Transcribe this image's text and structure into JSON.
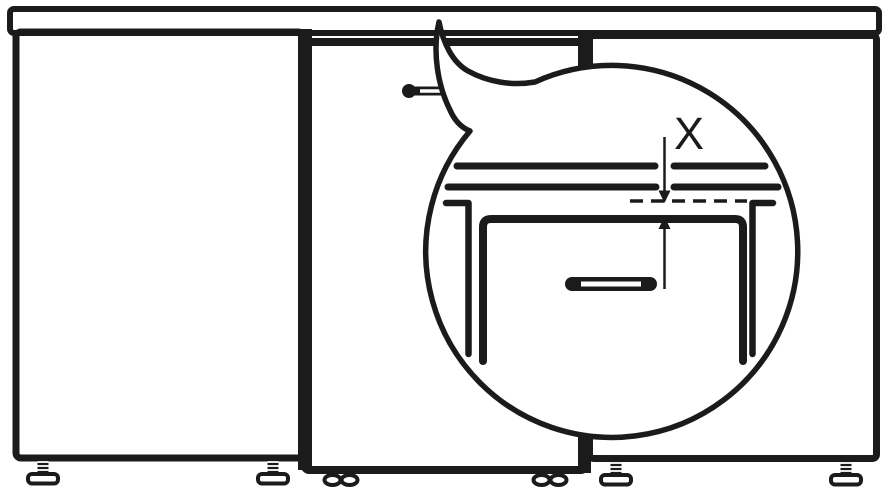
{
  "diagram": {
    "callout": {
      "label": "X"
    },
    "parts": [
      "countertop",
      "left-cabinet",
      "middle-cabinet",
      "right-cabinet",
      "adjustable-screw-foot",
      "oval-foot",
      "door-handle",
      "magnifier-callout-balloon",
      "worktop-underside-lines",
      "gap-reference-dashed-line",
      "side-panel-cross-sections",
      "drawer-front",
      "drawer-handle",
      "gap-dimension-arrows"
    ],
    "colors": {
      "line": "#1b1b1b",
      "background": "#ffffff"
    }
  }
}
